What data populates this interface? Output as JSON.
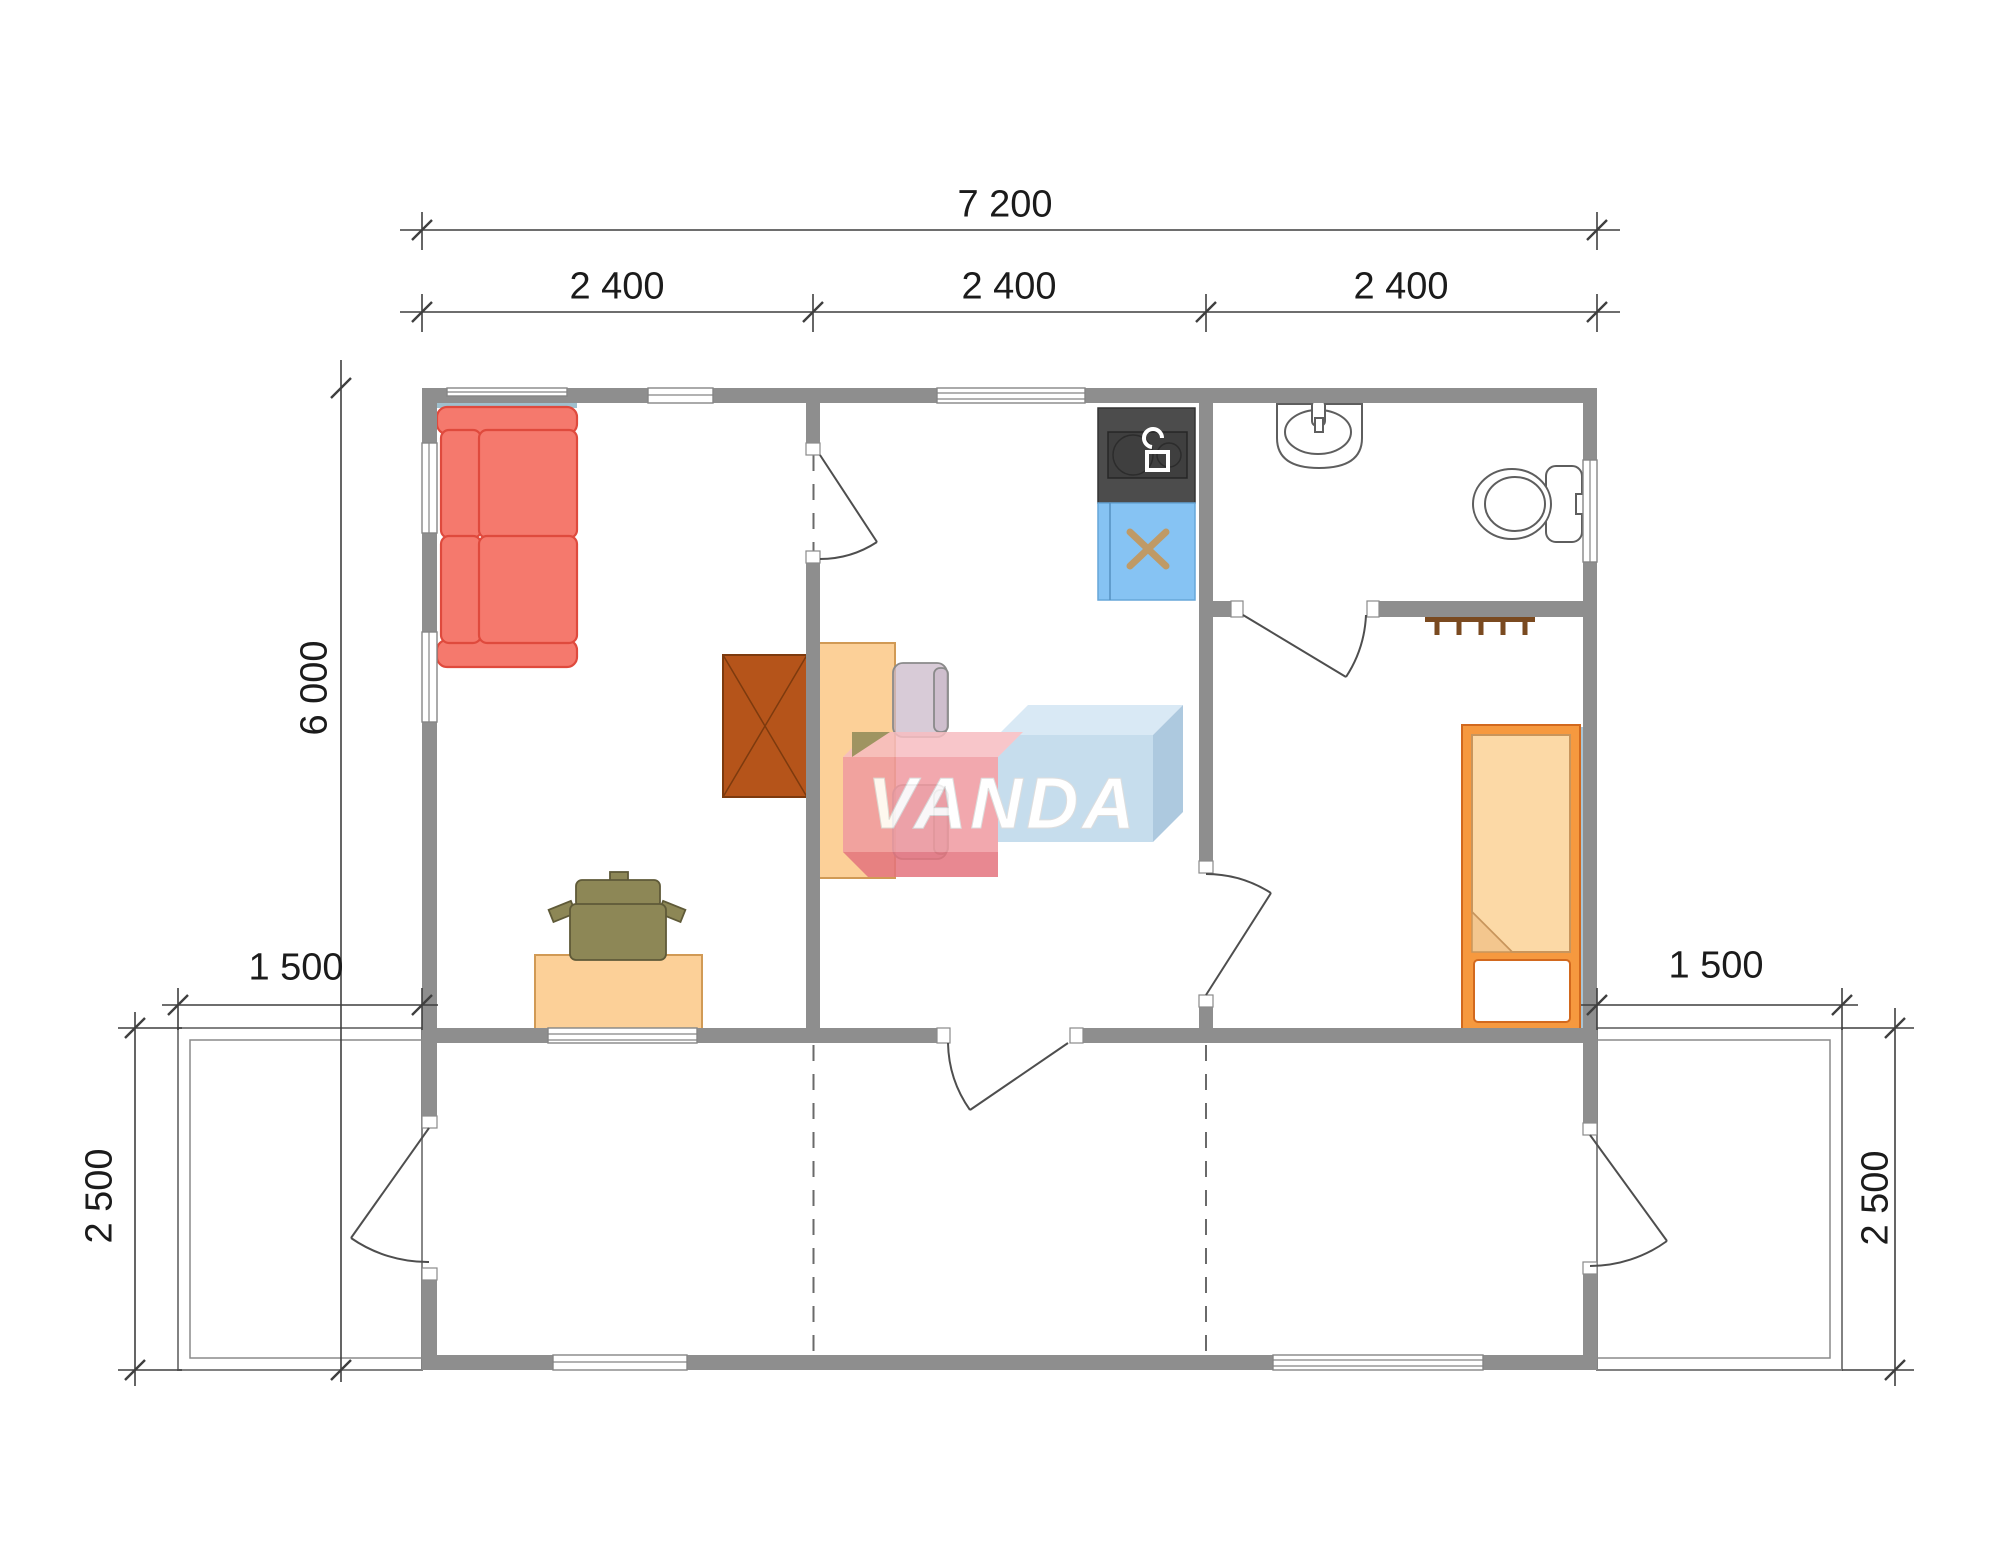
{
  "drawing": {
    "type": "floor-plan",
    "units": "mm",
    "watermark": {
      "text": "VANDA"
    }
  },
  "dimensions": {
    "overall_width": {
      "label": "7 200",
      "value_mm": 7200
    },
    "modules": [
      {
        "label": "2 400",
        "value_mm": 2400
      },
      {
        "label": "2 400",
        "value_mm": 2400
      },
      {
        "label": "2 400",
        "value_mm": 2400
      }
    ],
    "overall_depth": {
      "label": "6 000",
      "value_mm": 6000
    },
    "terrace_left_width": {
      "label": "1 500",
      "value_mm": 1500
    },
    "terrace_right_width": {
      "label": "1 500",
      "value_mm": 1500
    },
    "terrace_left_depth": {
      "label": "2 500",
      "value_mm": 2500
    },
    "terrace_right_depth": {
      "label": "2 500",
      "value_mm": 2500
    }
  },
  "colors": {
    "wall_gray": "#8e8e8e",
    "sofa_red": "#f5796d",
    "sofa_outline": "#df4a3d",
    "wood_peach": "#fcd098",
    "wood_outline": "#d19a55",
    "wardrobe_brown": "#b5541a",
    "bed_frame_orange": "#f6993f",
    "blanket_peach": "#fcd9a6",
    "chair_olive": "#8d8756",
    "dining_chair_mauve": "#cbb9c9",
    "stove_dark": "#4c4c4c",
    "sink_blue": "#86c3f3",
    "faucet_tan": "#bf9a66",
    "accent_teal": "#9fbfcd",
    "coatrack_brown": "#7a4a20",
    "watermark_pink": "#f09aa0",
    "watermark_red": "#e4747e",
    "watermark_blue": "#bdd8eb",
    "dimension_text": "#1b1b1b"
  },
  "furniture_icons": [
    "sofa-icon",
    "wardrobe-icon",
    "desk-icon",
    "office-chair-icon",
    "dining-table-icon",
    "dining-chair-icon",
    "stove-icon",
    "kitchen-sink-icon",
    "washbasin-icon",
    "toilet-icon",
    "coat-rack-icon",
    "bed-icon"
  ]
}
